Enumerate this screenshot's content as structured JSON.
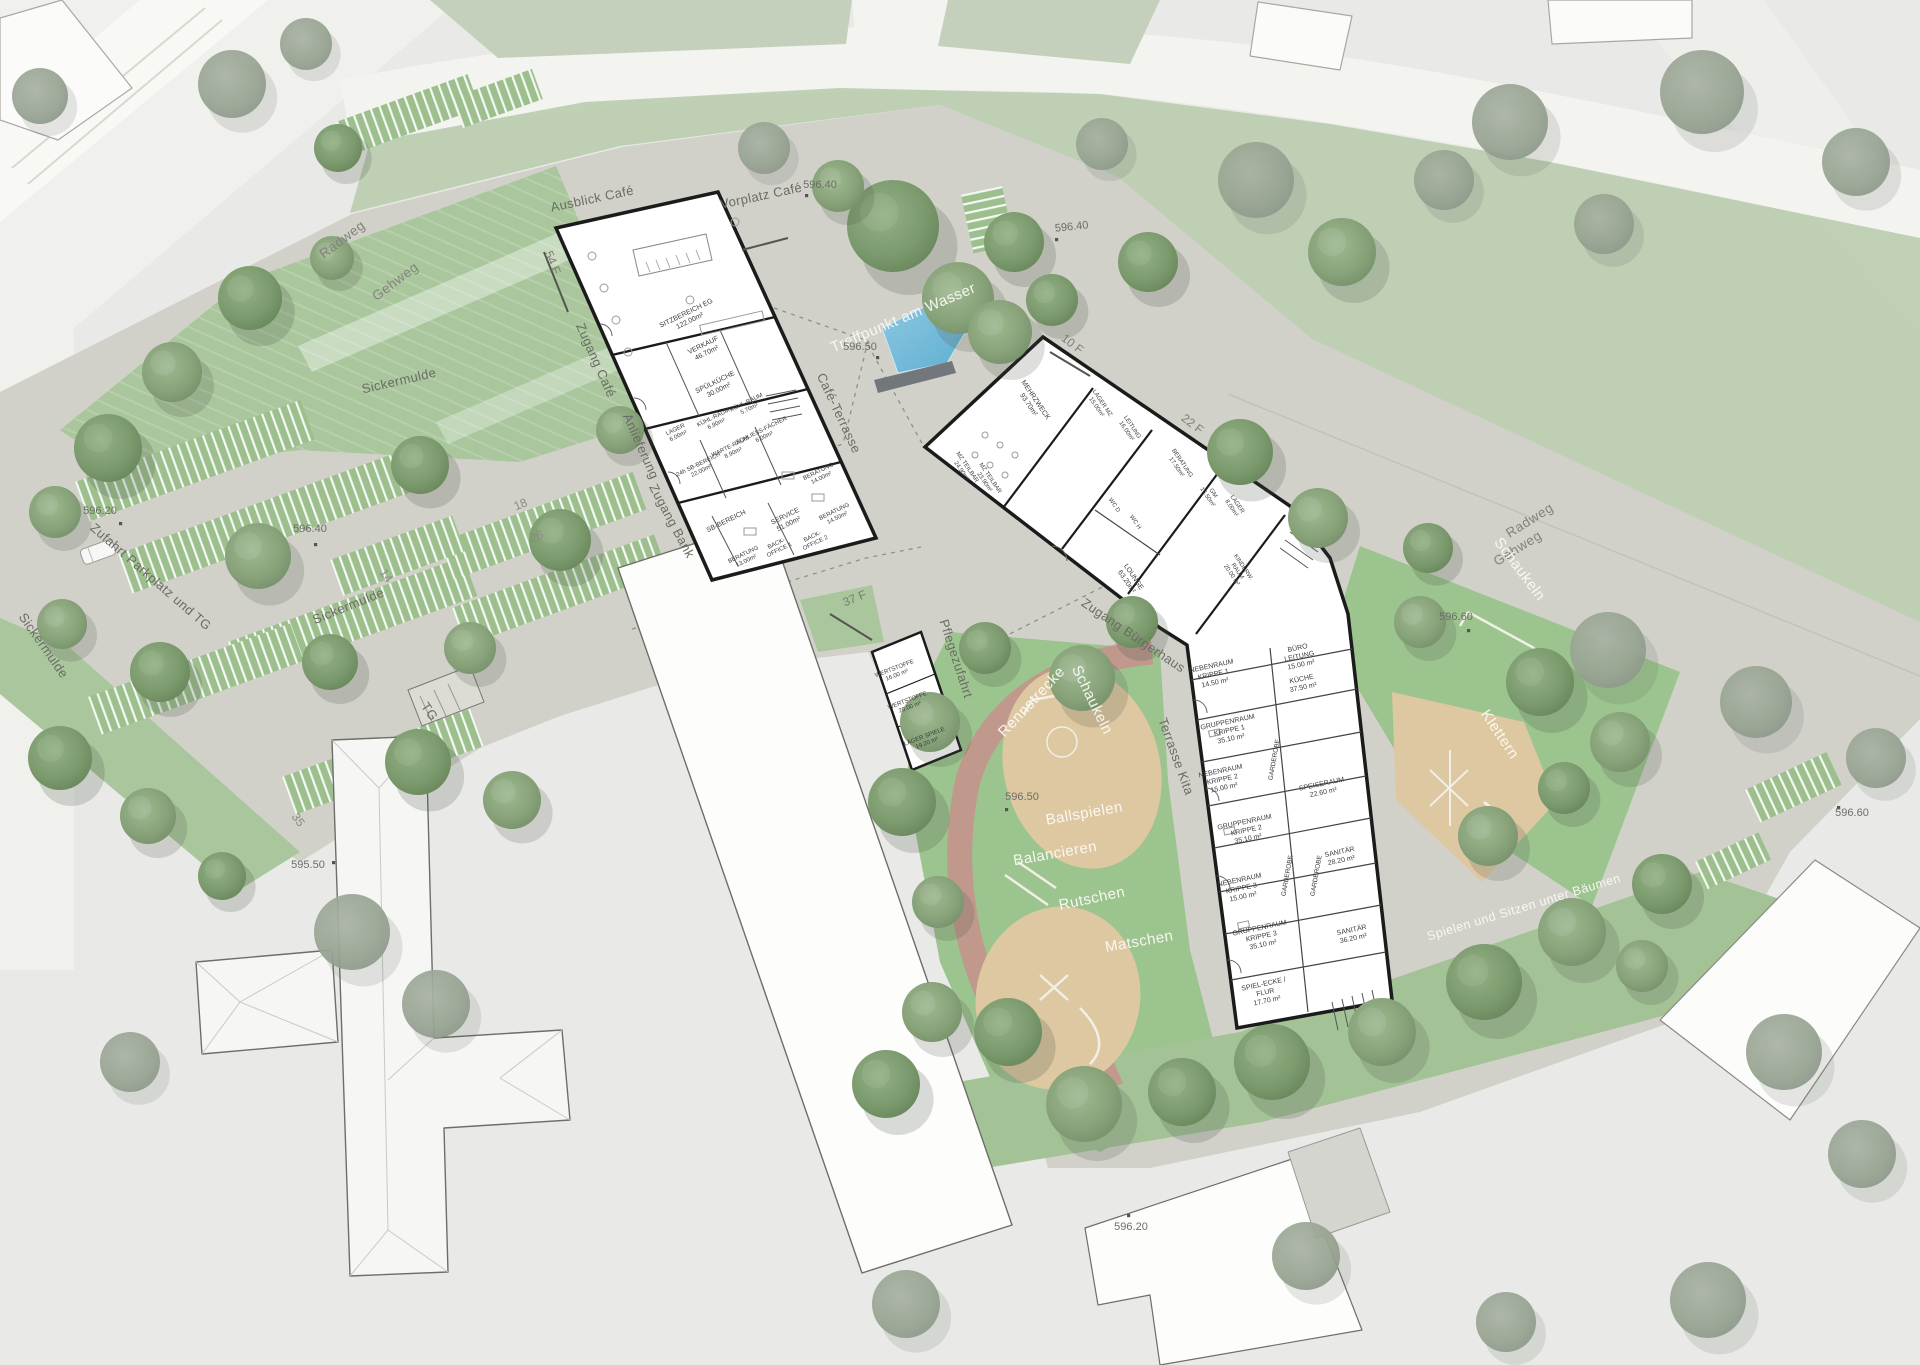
{
  "streets": {
    "radweg_nw": "Radweg",
    "gehweg_nw": "Gehweg",
    "radweg_e": "Radweg",
    "gehweg_e": "Gehweg"
  },
  "site": {
    "ausblick_cafe": "Ausblick Café",
    "vorplatz_cafe": "Vorplatz Café",
    "zugang_cafe": "Zugang Café",
    "anlieferung": "Anlieferung",
    "zugang_bank": "Zugang Bank",
    "cafe_terrasse": "Café-Terrasse",
    "treffpunkt": "Treffpunkt am Wasser",
    "zugang_buergerhaus": "Zugang Bürgerhaus",
    "terrasse_kita": "Terrasse Kita",
    "pflegezufahrt": "Pflegezufahrt",
    "zufahrt_parkplatz": "Zufahrt Parkplatz und TG",
    "sickermulde": "Sickermulde",
    "tg": "TG",
    "spielen_sitzen": "Spielen und Sitzen unter Bäumen"
  },
  "play": {
    "rennstrecke": "Rennstrecke",
    "schaukeln": "Schaukeln",
    "ballspielen": "Ballspielen",
    "balancieren": "Balancieren",
    "rutschen": "Rutschen",
    "matschen": "Matschen",
    "klettern": "Klettern"
  },
  "benches": {
    "b54": "54 F",
    "b10": "10 F",
    "b22": "22 F",
    "b37": "37 F"
  },
  "parking": {
    "p18": "18",
    "p26": "26",
    "p14": "14",
    "p35": "35"
  },
  "elevations": {
    "e59640": "596.40",
    "e59650": "596.50",
    "e59620": "596.20",
    "e59550": "595.50",
    "e59660": "596.60"
  },
  "cafe_bank": {
    "rooms": [
      {
        "l1": "SITZBEREICH EG",
        "l2": "122.00m²"
      },
      {
        "l1": "VERKAUF",
        "l2": "46.70m²"
      },
      {
        "l1": "SPÜLKÜCHE",
        "l2": "30.00m²"
      },
      {
        "l1": "KÜHL-RAUM",
        "l2": "6.90m²"
      },
      {
        "l1": "KÜHL-RAUM",
        "l2": "5.70m²"
      },
      {
        "l1": "LAGER",
        "l2": "6.00m²"
      },
      {
        "l1": "SCHLIESS-FÄCHER",
        "l2": "6.00m²"
      },
      {
        "l1": "WARTE-RAUM",
        "l2": "8.90m²"
      },
      {
        "l1": "24h SB-BEREICH",
        "l2": "22.00m²"
      },
      {
        "l1": "SB-BEREICH"
      },
      {
        "l1": "SERVICE",
        "l2": "51.00m²"
      },
      {
        "l1": "BERATUNG",
        "l2": "14.00m²"
      },
      {
        "l1": "BERATUNG",
        "l2": "14.50m²"
      },
      {
        "l1": "BERATUNG",
        "l2": "13.00m²"
      },
      {
        "l1": "BACK-",
        "l2": "OFFICE 1"
      },
      {
        "l1": "BACK-",
        "l2": "OFFICE 2"
      }
    ]
  },
  "buergerhaus": {
    "rooms": [
      {
        "l1": "MEHRZWECK",
        "l2": "93.70m²"
      },
      {
        "l1": "MZ TEILBAR",
        "l2": "24.90m²"
      },
      {
        "l1": "MZ TEILBAR",
        "l2": "23.90m²"
      },
      {
        "l1": "LAGER MZ",
        "l2": "15.00m²"
      },
      {
        "l1": "LEITUNG",
        "l2": "16.00m²"
      },
      {
        "l1": "BERATUNG",
        "l2": "17.50m²"
      },
      {
        "l1": "GM",
        "l2": "16.50m²"
      },
      {
        "l1": "LAGER",
        "l2": "8.00m²"
      },
      {
        "l1": "WC D"
      },
      {
        "l1": "WC H"
      },
      {
        "l1": "LOUNGE",
        "l2": "63.20m²"
      },
      {
        "l1": "KINDERW.",
        "l2": "RAUM",
        "l3": "20.00 m²"
      }
    ]
  },
  "kita": {
    "rooms": [
      {
        "l1": "NEBENRAUM",
        "l2": "KRIPPE 1",
        "l3": "14.50 m²"
      },
      {
        "l1": "BÜRO",
        "l2": "LEITUNG",
        "l3": "15.00 m²"
      },
      {
        "l1": "KÜCHE",
        "l2": "37.50 m²"
      },
      {
        "l1": "GRUPPENRAUM",
        "l2": "KRIPPE 1",
        "l3": "35.10 m²"
      },
      {
        "l1": "NEBENRAUM",
        "l2": "KRIPPE 2",
        "l3": "15.00 m²"
      },
      {
        "l1": "GRUPPENRAUM",
        "l2": "KRIPPE 2",
        "l3": "35.10 m²"
      },
      {
        "l1": "SPEISERAUM",
        "l2": "22.60 m²"
      },
      {
        "l1": "NEBENRAUM",
        "l2": "KRIPPE 3",
        "l3": "15.00 m²"
      },
      {
        "l1": "GRUPPENRAUM",
        "l2": "KRIPPE 3",
        "l3": "35.10 m²"
      },
      {
        "l1": "SANITÄR",
        "l2": "28.20 m²"
      },
      {
        "l1": "SANITÄR",
        "l2": "36.20 m²"
      },
      {
        "l1": "SPIEL-ECKE /",
        "l2": "FLUR",
        "l3": "17.70 m²"
      },
      {
        "l1": "GARDEROBE"
      }
    ]
  },
  "nebengebaeude": {
    "rooms": [
      {
        "l1": "WERTSTOFFE",
        "l2": "16.00 m²"
      },
      {
        "l1": "WERTSTOFFE",
        "l2": "20.00 m²"
      },
      {
        "l1": "LAGER SPIELE",
        "l2": "19.20 m²"
      }
    ]
  },
  "colors": {
    "green": "#a9c69c",
    "pavement": "#d1d1ca",
    "sand": "#ddc8a2",
    "track_red": "#c5938c",
    "water": "#74b9d8",
    "wall": "#1b1b1b"
  }
}
